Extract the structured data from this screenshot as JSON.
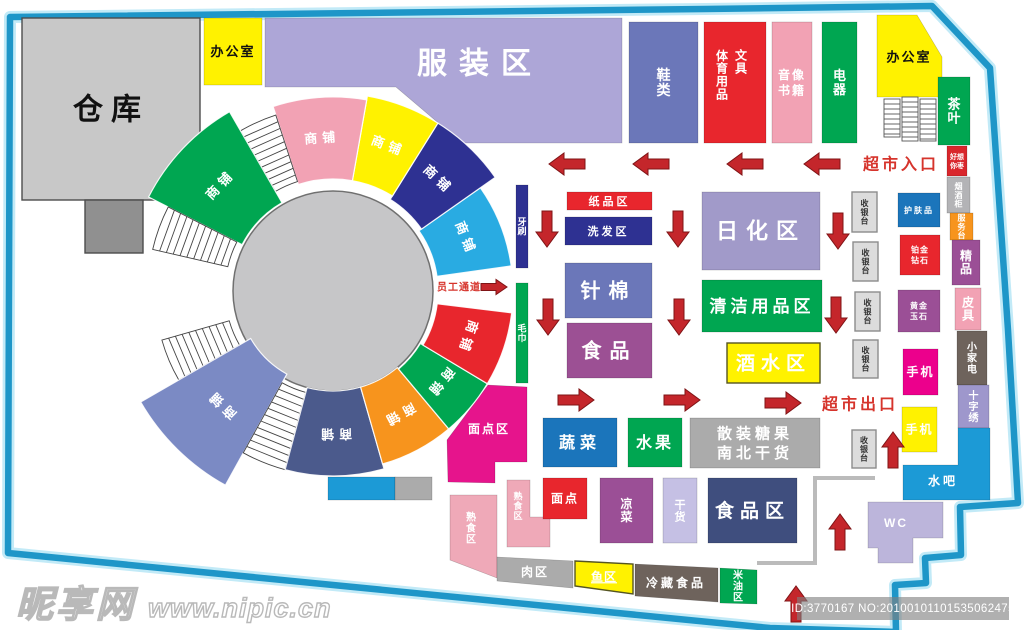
{
  "watermarks": {
    "left_brand": "昵享网",
    "left_url": "www.nipic.cn",
    "right_id": "ID:3770167 NO:20100101101535062475"
  },
  "border": {
    "points": "10,17 705,9 932,6 990,68 1008,330 1018,503 960,507 961,555 925,558 926,583 895,585 896,632 770,628 8,553",
    "color": "#1E96C8",
    "glow": "#C2EAF7"
  },
  "circle": {
    "cx": 333,
    "cy": 291,
    "r": 100,
    "fill": "#C6C6C8",
    "stroke": "#707070"
  },
  "ring": {
    "cx": 333,
    "cy": 291
  },
  "shop_label": "商铺",
  "wedges": [
    {
      "a1": 8,
      "a2": 35,
      "r1": 105,
      "r2": 180,
      "bg": "#29ABE2",
      "t": "商铺"
    },
    {
      "a1": 35,
      "a2": 58,
      "r1": 108,
      "r2": 198,
      "bg": "#2E3192",
      "t": "商铺"
    },
    {
      "a1": 58,
      "a2": 80,
      "r1": 112,
      "r2": 198,
      "bg": "#FFF200",
      "t": "商铺"
    },
    {
      "a1": 80,
      "a2": 108,
      "r1": 112,
      "r2": 194,
      "bg": "#F2A2B4",
      "t": "商铺"
    },
    {
      "a1": 108,
      "a2": 120,
      "r1": 115,
      "r2": 185,
      "stairs": 1
    },
    {
      "a1": 120,
      "a2": 153,
      "r1": 102,
      "r2": 207,
      "bg": "#00A651",
      "t": "商铺"
    },
    {
      "a1": 153,
      "a2": 167,
      "r1": 108,
      "r2": 185,
      "stairs": 1
    },
    {
      "a1": 196,
      "a2": 210,
      "r1": 108,
      "r2": 178,
      "stairs": 1
    },
    {
      "a1": 210,
      "a2": 241,
      "r1": 95,
      "r2": 222,
      "bg": "#7B8AC4",
      "t": "商铺"
    },
    {
      "a1": 241,
      "a2": 255,
      "r1": 105,
      "r2": 185,
      "stairs": 1
    },
    {
      "a1": 255,
      "a2": 286,
      "r1": 100,
      "r2": 185,
      "bg": "#4B5A8C",
      "t": "商铺"
    },
    {
      "a1": 286,
      "a2": 310,
      "r1": 100,
      "r2": 180,
      "bg": "#F7941D",
      "t": "商铺"
    },
    {
      "a1": 310,
      "a2": 329,
      "r1": 102,
      "r2": 180,
      "bg": "#00A651",
      "t": "商铺"
    },
    {
      "a1": 329,
      "a2": 353,
      "r1": 105,
      "r2": 180,
      "bg": "#E8262D",
      "t": "商铺"
    }
  ],
  "stair_block": {
    "stroke": "#555555",
    "cols": [
      [
        884,
        99,
        16,
        38
      ],
      [
        902,
        97,
        16,
        44
      ],
      [
        920,
        99,
        16,
        42
      ]
    ]
  },
  "lane": {
    "points": "875,478 815,478 815,563 757,563",
    "color": "#BBBBBB",
    "width": 4
  },
  "arrow_style": {
    "fill": "#C4262B",
    "stroke": "#7F1416"
  },
  "arrows": [
    {
      "id": "arrow-left-1",
      "d": "l",
      "x": 567,
      "y": 164
    },
    {
      "id": "arrow-left-2",
      "d": "l",
      "x": 651,
      "y": 164
    },
    {
      "id": "arrow-left-3",
      "d": "l",
      "x": 745,
      "y": 164
    },
    {
      "id": "arrow-left-4",
      "d": "l",
      "x": 822,
      "y": 164
    },
    {
      "id": "arrow-down-1",
      "d": "d",
      "x": 547,
      "y": 229
    },
    {
      "id": "arrow-down-2",
      "d": "d",
      "x": 678,
      "y": 229
    },
    {
      "id": "arrow-down-3",
      "d": "d",
      "x": 838,
      "y": 231
    },
    {
      "id": "arrow-down-4",
      "d": "d",
      "x": 548,
      "y": 317
    },
    {
      "id": "arrow-down-5",
      "d": "d",
      "x": 679,
      "y": 317
    },
    {
      "id": "arrow-down-6",
      "d": "d",
      "x": 836,
      "y": 315
    },
    {
      "id": "arrow-right-1",
      "d": "r",
      "x": 576,
      "y": 400
    },
    {
      "id": "arrow-right-2",
      "d": "r",
      "x": 682,
      "y": 400
    },
    {
      "id": "arrow-right-3",
      "d": "r",
      "x": 783,
      "y": 403
    },
    {
      "id": "arrow-up-1",
      "d": "u",
      "x": 893,
      "y": 450
    },
    {
      "id": "arrow-up-2",
      "d": "u",
      "x": 840,
      "y": 532
    },
    {
      "id": "arrow-up-3",
      "d": "u",
      "x": 796,
      "y": 604
    },
    {
      "id": "arrow-staff",
      "d": "r",
      "x": 494,
      "y": 287,
      "s": 1
    }
  ],
  "zones": [
    {
      "id": "warehouse",
      "t": "仓库",
      "x": 22,
      "y": 18,
      "w": 178,
      "h": 182,
      "bg": "#C8C8C8",
      "fg": "#111111",
      "fs": 30,
      "ls": 8,
      "bd": "#4D4D4D"
    },
    {
      "id": "warehouse-annex",
      "x": 85,
      "y": 200,
      "w": 58,
      "h": 53,
      "bg": "#909090",
      "bd": "#4D4D4D"
    },
    {
      "id": "office-left",
      "t": "办公室",
      "x": 204,
      "y": 18,
      "w": 58,
      "h": 67,
      "bg": "#FFF200",
      "fg": "#111111",
      "fs": 13,
      "ls": 2
    },
    {
      "id": "clothing",
      "t": "服装区",
      "pts": "265,18 622,18 622,143 462,143 396,87 265,87",
      "bg": "#ADA6D7",
      "fs": 30,
      "ls": 12,
      "lx": 480,
      "ly": 63
    },
    {
      "id": "shoes",
      "t": "鞋类",
      "x": 629,
      "y": 22,
      "w": 69,
      "h": 121,
      "bg": "#6B77B9",
      "fs": 14,
      "v": 1
    },
    {
      "id": "sports-stationery",
      "x": 704,
      "y": 22,
      "w": 62,
      "h": 121,
      "bg": "#E8262D"
    },
    {
      "id": "sports-label",
      "t": "体育用品",
      "lx": 722,
      "ly": 75,
      "fs": 12,
      "v": 1,
      "bg": "none"
    },
    {
      "id": "stationery-label",
      "t": "文具",
      "lx": 741,
      "ly": 62,
      "fs": 12,
      "v": 1,
      "bg": "none"
    },
    {
      "id": "av-books",
      "t": "音像\n书籍",
      "x": 772,
      "y": 22,
      "w": 40,
      "h": 121,
      "bg": "#F2A2B4",
      "fs": 12,
      "ls": 2
    },
    {
      "id": "electronics",
      "t": "电器",
      "x": 822,
      "y": 22,
      "w": 35,
      "h": 121,
      "bg": "#00A651",
      "fs": 13,
      "v": 1
    },
    {
      "id": "office-right",
      "t": "办公室",
      "pts": "877,15 917,15 942,57 942,97 877,97",
      "bg": "#FFF200",
      "fg": "#111111",
      "fs": 13,
      "ls": 2,
      "lx": 909,
      "ly": 57
    },
    {
      "id": "tea",
      "t": "茶叶",
      "x": 938,
      "y": 77,
      "w": 32,
      "h": 68,
      "bg": "#00A651",
      "fs": 13,
      "v": 1
    },
    {
      "id": "haoxiangni",
      "t": "好想\n你枣",
      "x": 947,
      "y": 146,
      "w": 20,
      "h": 30,
      "bg": "#D9262C",
      "fs": 7
    },
    {
      "id": "tobacco-counter",
      "t": "烟酒柜",
      "x": 947,
      "y": 177,
      "w": 23,
      "h": 36,
      "bg": "#B3B3B6",
      "fs": 8,
      "v": 1
    },
    {
      "id": "service-desk",
      "t": "服务台",
      "x": 950,
      "y": 213,
      "w": 23,
      "h": 27,
      "bg": "#F7941D",
      "fs": 8,
      "v": 1
    },
    {
      "id": "boutique",
      "t": "精品",
      "x": 952,
      "y": 240,
      "w": 28,
      "h": 45,
      "bg": "#9B4F96",
      "fs": 12,
      "v": 1
    },
    {
      "id": "leather",
      "t": "皮具",
      "x": 955,
      "y": 288,
      "w": 26,
      "h": 42,
      "bg": "#F2A2B4",
      "fs": 12,
      "v": 1
    },
    {
      "id": "small-appliance",
      "t": "小家电",
      "x": 957,
      "y": 331,
      "w": 30,
      "h": 54,
      "bg": "#6E635C",
      "fs": 10,
      "v": 1
    },
    {
      "id": "cross-stitch",
      "t": "十字绣",
      "x": 958,
      "y": 385,
      "w": 31,
      "h": 43,
      "bg": "#9E97CC",
      "fs": 10,
      "v": 1
    },
    {
      "id": "water-bar",
      "t": "水吧",
      "pts": "958,428 990,428 990,500 903,500 903,465 958,465",
      "bg": "#1C9AD6",
      "fs": 12,
      "ls": 3,
      "lx": 943,
      "ly": 481
    },
    {
      "id": "wc",
      "t": "WC",
      "pts": "868,502 943,502 943,538 913,538 913,563 878,563 878,548 868,548",
      "bg": "#BCB5DB",
      "fs": 12,
      "ls": 2,
      "lx": 896,
      "ly": 523
    },
    {
      "id": "cashier-1",
      "t": "收银台",
      "x": 852,
      "y": 192,
      "w": 25,
      "h": 40,
      "bg": "#DCDCDC",
      "fg": "#333333",
      "fs": 8,
      "v": 1,
      "bd": "#8C8C8C"
    },
    {
      "id": "cashier-2",
      "t": "收银台",
      "x": 853,
      "y": 242,
      "w": 25,
      "h": 39,
      "bg": "#DCDCDC",
      "fg": "#333333",
      "fs": 8,
      "v": 1,
      "bd": "#8C8C8C"
    },
    {
      "id": "cashier-3",
      "t": "收银台",
      "x": 855,
      "y": 292,
      "w": 25,
      "h": 39,
      "bg": "#DCDCDC",
      "fg": "#333333",
      "fs": 8,
      "v": 1,
      "bd": "#8C8C8C"
    },
    {
      "id": "cashier-4",
      "t": "收银台",
      "x": 853,
      "y": 340,
      "w": 25,
      "h": 38,
      "bg": "#DCDCDC",
      "fg": "#333333",
      "fs": 8,
      "v": 1,
      "bd": "#8C8C8C"
    },
    {
      "id": "cashier-5",
      "t": "收银台",
      "x": 852,
      "y": 430,
      "w": 24,
      "h": 38,
      "bg": "#DCDCDC",
      "fg": "#333333",
      "fs": 8,
      "v": 1,
      "bd": "#8C8C8C"
    },
    {
      "id": "skincare",
      "t": "护肤品",
      "x": 898,
      "y": 193,
      "w": 42,
      "h": 34,
      "bg": "#1B75BB",
      "fs": 8,
      "ls": 2
    },
    {
      "id": "platinum-diamond",
      "t": "铂金\n钻石",
      "x": 900,
      "y": 235,
      "w": 40,
      "h": 40,
      "bg": "#E8262D",
      "fs": 8,
      "ls": 1
    },
    {
      "id": "gold-jade",
      "t": "黄金\n玉石",
      "x": 898,
      "y": 290,
      "w": 42,
      "h": 42,
      "bg": "#9B4F96",
      "fs": 8,
      "ls": 1
    },
    {
      "id": "phone-1",
      "t": "手机",
      "x": 903,
      "y": 349,
      "w": 35,
      "h": 46,
      "bg": "#EC008C",
      "fs": 12,
      "ls": 2
    },
    {
      "id": "phone-2",
      "t": "手机",
      "x": 902,
      "y": 407,
      "w": 35,
      "h": 45,
      "bg": "#FFF200",
      "fs": 12,
      "ls": 2
    },
    {
      "id": "daily-chemical",
      "t": "日化区",
      "x": 702,
      "y": 192,
      "w": 118,
      "h": 78,
      "bg": "#A19AC9",
      "fs": 22,
      "ls": 8
    },
    {
      "id": "cleaning",
      "t": "清洁用品区",
      "x": 702,
      "y": 280,
      "w": 120,
      "h": 52,
      "bg": "#00A651",
      "fs": 17,
      "ls": 4
    },
    {
      "id": "liquor",
      "t": "酒水区",
      "x": 727,
      "y": 343,
      "w": 93,
      "h": 40,
      "bg": "#FFF200",
      "fs": 19,
      "ls": 6,
      "bd": "#555522"
    },
    {
      "id": "paper-goods",
      "t": "纸品区",
      "x": 567,
      "y": 192,
      "w": 85,
      "h": 18,
      "bg": "#E8262D",
      "fs": 11,
      "ls": 3
    },
    {
      "id": "shampoo",
      "t": "洗发区",
      "x": 565,
      "y": 217,
      "w": 87,
      "h": 28,
      "bg": "#2E3192",
      "fs": 11,
      "ls": 3
    },
    {
      "id": "needle-cotton",
      "t": "针棉",
      "x": 565,
      "y": 263,
      "w": 87,
      "h": 55,
      "bg": "#6B77B9",
      "fs": 20,
      "ls": 8
    },
    {
      "id": "food-center",
      "t": "食品",
      "x": 567,
      "y": 323,
      "w": 85,
      "h": 55,
      "bg": "#9C5094",
      "fs": 20,
      "ls": 8
    },
    {
      "id": "toothbrush",
      "t": "牙刷",
      "x": 516,
      "y": 185,
      "w": 12,
      "h": 83,
      "bg": "#2E3192",
      "fs": 9,
      "v": 1
    },
    {
      "id": "towel",
      "t": "毛巾",
      "x": 516,
      "y": 283,
      "w": 12,
      "h": 100,
      "bg": "#00A651",
      "fs": 9,
      "v": 1
    },
    {
      "id": "vegetables",
      "t": "蔬菜",
      "x": 543,
      "y": 418,
      "w": 74,
      "h": 49,
      "bg": "#1B75BB",
      "fs": 16,
      "ls": 5
    },
    {
      "id": "fruits",
      "t": "水果",
      "x": 628,
      "y": 418,
      "w": 54,
      "h": 49,
      "bg": "#00A651",
      "fs": 16,
      "ls": 3
    },
    {
      "id": "bulk-goods",
      "t": "散装糖果\n南北干货",
      "x": 690,
      "y": 418,
      "w": 130,
      "h": 50,
      "bg": "#ABABAB",
      "fs": 15,
      "ls": 4
    },
    {
      "id": "pastry-area",
      "t": "面点区",
      "pts": "488,385 527,387 527,462 495,462 495,483 448,482 447,440",
      "bg": "#E6148C",
      "fs": 12,
      "ls": 2,
      "lx": 489,
      "ly": 429
    },
    {
      "id": "cooked-food-1",
      "t": "熟食区",
      "pts": "507,480 530,480 530,517 550,517 550,547 507,547",
      "bg": "#EFA9B8",
      "fs": 9,
      "v": 1,
      "lx": 518,
      "ly": 506
    },
    {
      "id": "cooked-food-2",
      "t": "熟食区",
      "pts": "450,495 497,495 497,578 450,560",
      "bg": "#EFA9B8",
      "fs": 10,
      "v": 1,
      "lx": 471,
      "ly": 528
    },
    {
      "id": "pastry",
      "t": "面点",
      "x": 543,
      "y": 478,
      "w": 44,
      "h": 41,
      "bg": "#E8262D",
      "fs": 12,
      "ls": 2
    },
    {
      "id": "cold-dishes",
      "t": "凉菜",
      "x": 600,
      "y": 478,
      "w": 53,
      "h": 65,
      "bg": "#9B4F96",
      "fs": 12,
      "v": 1
    },
    {
      "id": "dry-goods",
      "t": "干货",
      "x": 663,
      "y": 478,
      "w": 34,
      "h": 65,
      "bg": "#C5C0E4",
      "fs": 11,
      "v": 1
    },
    {
      "id": "food-area",
      "t": "食品区",
      "x": 708,
      "y": 478,
      "w": 89,
      "h": 65,
      "bg": "#3F4E7E",
      "fs": 19,
      "ls": 6
    },
    {
      "id": "meat",
      "t": "肉区",
      "pts": "497,557 573,561 573,588 497,581",
      "bg": "#ABABAB",
      "fs": 12,
      "ls": 2,
      "lx": 535,
      "ly": 572
    },
    {
      "id": "fish",
      "t": "鱼区",
      "pts": "575,561 633,564 633,594 575,586",
      "bg": "#FFF200",
      "fs": 12,
      "ls": 1,
      "lx": 604,
      "ly": 577,
      "u": 1,
      "bd": "#555522"
    },
    {
      "id": "frozen-food",
      "t": "冷藏食品",
      "pts": "635,564 718,568 718,602 635,596",
      "bg": "#6E635C",
      "fs": 12,
      "ls": 3,
      "lx": 676,
      "ly": 583
    },
    {
      "id": "rice-oil",
      "t": "米油区",
      "pts": "720,568 757,570 757,604 720,603",
      "bg": "#00A651",
      "fs": 10,
      "v": 1,
      "lx": 738,
      "ly": 586
    },
    {
      "id": "cyan-bar",
      "x": 328,
      "y": 477,
      "w": 67,
      "h": 23,
      "bg": "#1C9AD6"
    },
    {
      "id": "gray-bar",
      "x": 395,
      "y": 477,
      "w": 37,
      "h": 23,
      "bg": "#ABABAB"
    },
    {
      "id": "entrance-label",
      "t": "超市入口",
      "lx": 901,
      "ly": 164,
      "fs": 16,
      "fg": "#D6342C",
      "bg": "none",
      "ls": 3
    },
    {
      "id": "exit-label",
      "t": "超市出口",
      "lx": 860,
      "ly": 404,
      "fs": 16,
      "fg": "#D6342C",
      "bg": "none",
      "ls": 3
    },
    {
      "id": "staff-passage-label",
      "t": "员工通道",
      "lx": 459,
      "ly": 287,
      "fs": 10,
      "fg": "#D6342C",
      "bg": "none",
      "ls": 1
    }
  ]
}
